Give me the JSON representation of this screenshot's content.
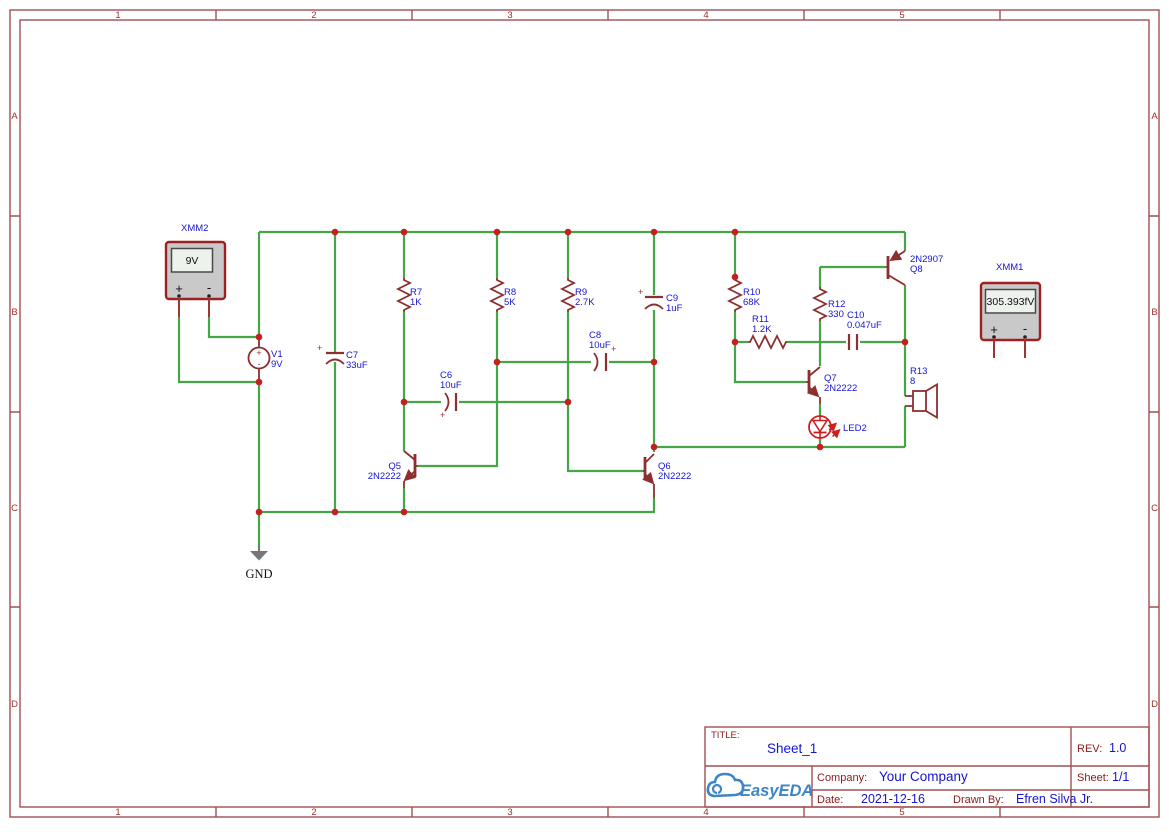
{
  "app": {
    "name": "EasyEDA Schematic Sheet"
  },
  "colors": {
    "wire": "#46a546",
    "comp": "#8c2f2f",
    "junction": "#c42020",
    "blue": "#1515d0",
    "frame": "#a05050",
    "framedigit": "#a03030",
    "tbred": "#8b1a1a",
    "ledred": "#cc2020",
    "gray": "#777777",
    "mmborder": "#9e2121",
    "mmbody": "#c9c9c9",
    "mmdisplay": "#edf2ec",
    "logoblue": "#3c85c8"
  },
  "frame": {
    "columns": [
      "1",
      "2",
      "3",
      "4",
      "5"
    ],
    "rows": [
      "A",
      "B",
      "C",
      "D"
    ]
  },
  "symbols": {
    "plus": "+",
    "minus": "-"
  },
  "ground": {
    "label": "GND"
  },
  "instruments": {
    "xmm2": {
      "label": "XMM2",
      "display": "9V"
    },
    "xmm1": {
      "label": "XMM1",
      "display": "305.393fV"
    }
  },
  "components": {
    "v1": {
      "ref": "V1",
      "value": "9V"
    },
    "c7": {
      "ref": "C7",
      "value": "33uF"
    },
    "r7": {
      "ref": "R7",
      "value": "1K"
    },
    "r8": {
      "ref": "R8",
      "value": "5K"
    },
    "r9": {
      "ref": "R9",
      "value": "2.7K"
    },
    "c9": {
      "ref": "C9",
      "value": "1uF"
    },
    "c6": {
      "ref": "C6",
      "value": "10uF"
    },
    "c8": {
      "ref": "C8",
      "value": "10uF"
    },
    "r10": {
      "ref": "R10",
      "value": "68K"
    },
    "r11": {
      "ref": "R11",
      "value": "1.2K"
    },
    "r12": {
      "ref": "R12",
      "value": "330"
    },
    "c10": {
      "ref": "C10",
      "value": "0.047uF"
    },
    "q5": {
      "ref": "Q5",
      "value": "2N2222"
    },
    "q6": {
      "ref": "Q6",
      "value": "2N2222"
    },
    "q7": {
      "ref": "Q7",
      "value": "2N2222"
    },
    "q8": {
      "ref": "Q8",
      "value": "2N2907"
    },
    "led2": {
      "ref": "LED2"
    },
    "r13": {
      "ref": "R13",
      "value": "8"
    }
  },
  "title_block": {
    "title_label": "TITLE:",
    "title": "Sheet_1",
    "rev_label": "REV:",
    "rev": "1.0",
    "company_label": "Company:",
    "company": "Your Company",
    "sheet_label": "Sheet:",
    "sheet": "1/1",
    "date_label": "Date:",
    "date": "2021-12-16",
    "drawn_by_label": "Drawn By:",
    "drawn_by": "Efren Silva Jr.",
    "logo_text": "EasyEDA"
  }
}
